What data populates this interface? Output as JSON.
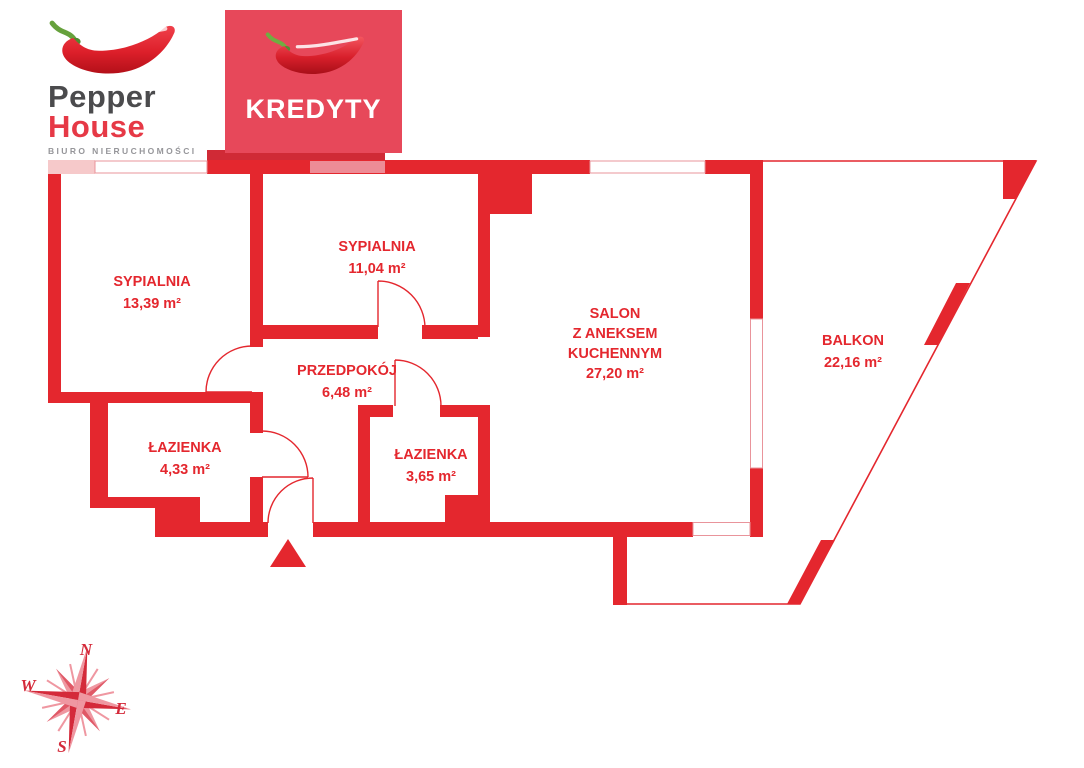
{
  "logo": {
    "line1": "Pepper",
    "line2": "House",
    "subtitle": "BIURO NIERUCHOMOŚCI"
  },
  "banner": {
    "label": "KREDYTY"
  },
  "rooms": [
    {
      "name": "SYPIALNIA",
      "area": "13,39 m²"
    },
    {
      "name": "SYPIALNIA",
      "area": "11,04 m²"
    },
    {
      "name": "PRZEDPOKÓJ",
      "area": "6,48 m²"
    },
    {
      "name": "ŁAZIENKA",
      "area": "4,33 m²"
    },
    {
      "name": "ŁAZIENKA",
      "area": "3,65 m²"
    },
    {
      "name_lines": [
        "SALON",
        "Z ANEKSEM",
        "KUCHENNYM"
      ],
      "area": "27,20 m²"
    },
    {
      "name": "BALKON",
      "area": "22,16 m²"
    }
  ],
  "compass": {
    "n": "N",
    "e": "E",
    "s": "S",
    "w": "W"
  },
  "colors": {
    "plan_red": "#e4272e",
    "banner_red": "#e7485a",
    "light_pink": "#f6c9ca",
    "window_pink": "#ed8c96",
    "logo_gray": "#4b4b4d",
    "logo_red": "#e63946",
    "subtitle_gray": "#96969a",
    "compass_red": "#d42a3a"
  }
}
